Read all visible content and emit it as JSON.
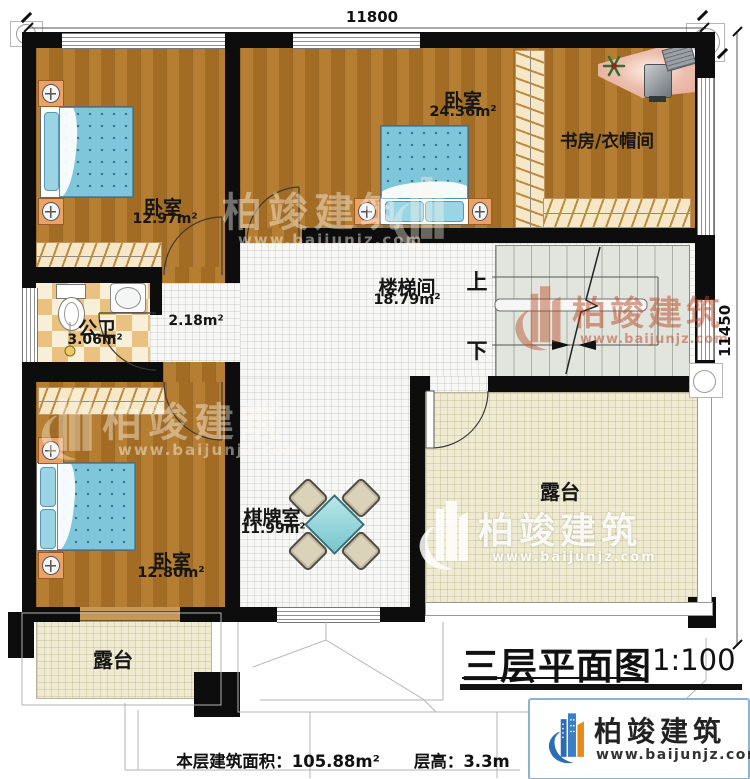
{
  "plan": {
    "dimensions": {
      "top": "11800",
      "right": "11450"
    },
    "rooms": {
      "bedroom1": {
        "name": "卧室",
        "area": "12.97m²"
      },
      "bedroom2": {
        "name": "卧室",
        "area": "24.36m²"
      },
      "study": {
        "name": "书房/衣帽间"
      },
      "bathroom": {
        "name": "公卫",
        "area": "3.06m²"
      },
      "hallway": {
        "area": "2.18m²"
      },
      "stairwell": {
        "name": "楼梯间",
        "area": "18.79m²"
      },
      "gameroom": {
        "name": "棋牌室",
        "area": "11.99m²"
      },
      "bedroom3": {
        "name": "卧室",
        "area": "12.80m²"
      },
      "terrace_right": {
        "name": "露台"
      },
      "terrace_bottom": {
        "name": "露台"
      }
    },
    "stairs": {
      "up": "上",
      "down": "下"
    }
  },
  "titleblock": {
    "title": "三层平面图",
    "scale": "1:100"
  },
  "footer": {
    "area_label": "本层建筑面积：",
    "area_value": "105.88m²",
    "height_label": "层高：",
    "height_value": "3.3m"
  },
  "branding": {
    "name": "柏竣建筑",
    "website": "www.baijunjz.com"
  },
  "watermark": {
    "name": "柏竣建筑",
    "website": "www.baijunjz.com"
  },
  "colors": {
    "wall": "#0d0d0d",
    "wood": "#ad7428",
    "tile": "#f7f7f5",
    "terrace": "#eeebd2",
    "accent_blue": "#2a6db5",
    "accent_orange": "#e8891c"
  }
}
